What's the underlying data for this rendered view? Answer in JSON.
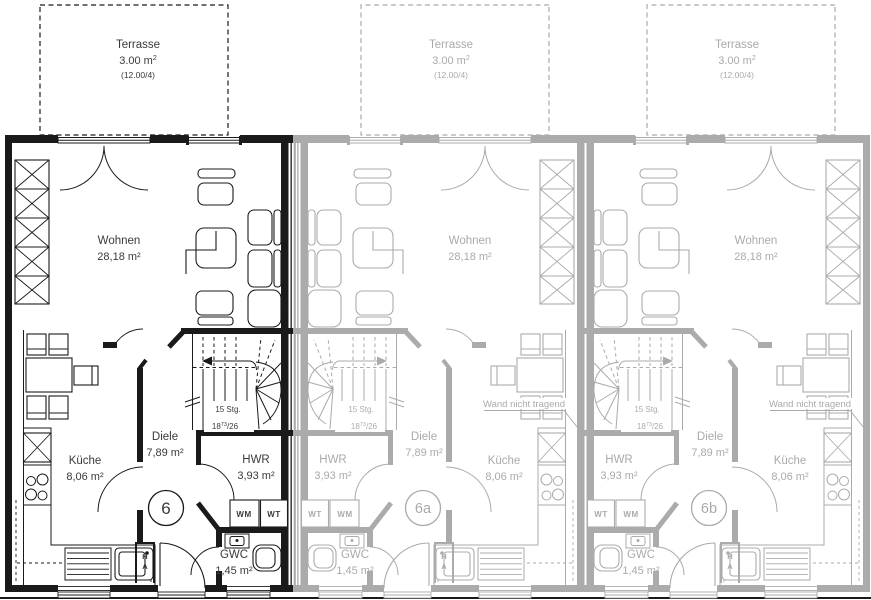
{
  "colors": {
    "active_unit": "#1a1a1a",
    "faded_unit": "#ababab",
    "active_text": "#3a3a3a",
    "faded_text": "#aaaaaa",
    "background": "#ffffff"
  },
  "terrace": {
    "label": "Terrasse",
    "area_base": "3.00 m",
    "area_exp": "2",
    "calc": "(12.00/4)"
  },
  "rooms": {
    "wohnen": {
      "name": "Wohnen",
      "area": "28,18 m²"
    },
    "diele": {
      "name": "Diele",
      "area": "7,89 m²"
    },
    "kueche": {
      "name": "Küche",
      "area": "8,06 m²"
    },
    "hwr": {
      "name": "HWR",
      "area": "3,93 m²"
    },
    "gwc": {
      "name": "GWC",
      "area": "1,45 m²"
    }
  },
  "stairs": {
    "count": "15 Stg.",
    "riser_base": "18",
    "riser_sup": "73",
    "riser_rest": "/26"
  },
  "appliances": {
    "wm": "WM",
    "wt": "WT"
  },
  "ha": {
    "line1": "H",
    "line2": "A"
  },
  "units": [
    {
      "id": "6"
    },
    {
      "id": "6a"
    },
    {
      "id": "6b"
    }
  ],
  "annotations": {
    "wand": "Wand nicht tragend"
  }
}
